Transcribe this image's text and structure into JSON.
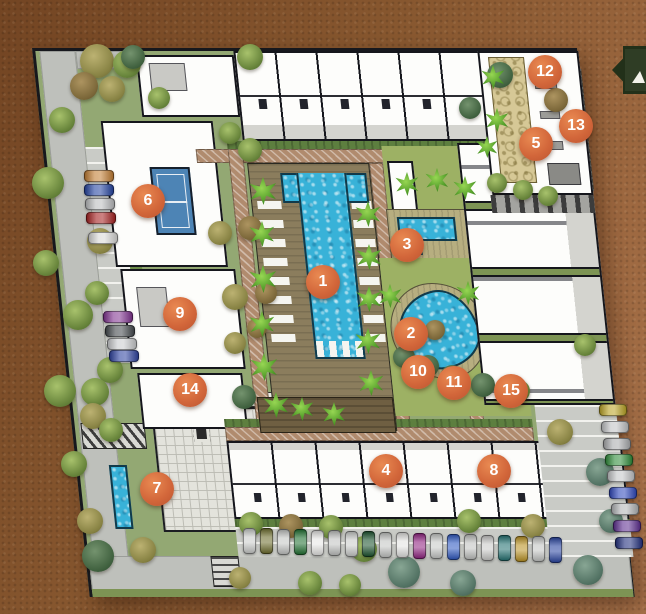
{
  "palette": {
    "marker_orange": "#d2663a",
    "pool_blue": "#38b2d8",
    "plan_green": "#93a873",
    "ribbon_green": "#2f3d25",
    "background_brown": "#8a5a33"
  },
  "markers": [
    {
      "n": "1",
      "x": 323,
      "y": 282
    },
    {
      "n": "2",
      "x": 411,
      "y": 334
    },
    {
      "n": "3",
      "x": 407,
      "y": 245
    },
    {
      "n": "4",
      "x": 386,
      "y": 471
    },
    {
      "n": "5",
      "x": 536,
      "y": 144
    },
    {
      "n": "6",
      "x": 148,
      "y": 201
    },
    {
      "n": "7",
      "x": 157,
      "y": 489
    },
    {
      "n": "8",
      "x": 494,
      "y": 471
    },
    {
      "n": "9",
      "x": 180,
      "y": 314
    },
    {
      "n": "10",
      "x": 418,
      "y": 372
    },
    {
      "n": "11",
      "x": 454,
      "y": 383
    },
    {
      "n": "12",
      "x": 545,
      "y": 72
    },
    {
      "n": "13",
      "x": 576,
      "y": 126
    },
    {
      "n": "14",
      "x": 190,
      "y": 390
    },
    {
      "n": "15",
      "x": 511,
      "y": 391
    }
  ],
  "ribbon": {
    "glyph": "sail-triangle-icon"
  },
  "trees": [
    [
      97,
      61,
      17,
      "o"
    ],
    [
      127,
      64,
      14,
      "g"
    ],
    [
      84,
      86,
      14,
      "b"
    ],
    [
      112,
      89,
      13,
      "o"
    ],
    [
      133,
      57,
      12,
      "k"
    ],
    [
      250,
      57,
      13,
      "g"
    ],
    [
      48,
      183,
      16,
      "g"
    ],
    [
      100,
      241,
      13,
      "o"
    ],
    [
      46,
      263,
      13,
      "g"
    ],
    [
      78,
      315,
      15,
      "g"
    ],
    [
      97,
      293,
      12,
      "g"
    ],
    [
      110,
      370,
      13,
      "g"
    ],
    [
      95,
      392,
      14,
      "g"
    ],
    [
      60,
      391,
      16,
      "g"
    ],
    [
      93,
      416,
      13,
      "o"
    ],
    [
      111,
      430,
      12,
      "g"
    ],
    [
      74,
      464,
      13,
      "g"
    ],
    [
      90,
      521,
      13,
      "o"
    ],
    [
      98,
      556,
      16,
      "k"
    ],
    [
      143,
      550,
      13,
      "o"
    ],
    [
      250,
      150,
      12,
      "g"
    ],
    [
      230,
      133,
      11,
      "g"
    ],
    [
      159,
      98,
      11,
      "g"
    ],
    [
      62,
      120,
      13,
      "g"
    ],
    [
      500,
      75,
      13,
      "k"
    ],
    [
      556,
      100,
      12,
      "b"
    ],
    [
      470,
      108,
      11,
      "k"
    ],
    [
      497,
      183,
      10,
      "g"
    ],
    [
      523,
      190,
      10,
      "g"
    ],
    [
      548,
      196,
      10,
      "g"
    ],
    [
      220,
      233,
      12,
      "o"
    ],
    [
      250,
      228,
      12,
      "b"
    ],
    [
      235,
      297,
      13,
      "o"
    ],
    [
      266,
      293,
      11,
      "b"
    ],
    [
      235,
      343,
      11,
      "o"
    ],
    [
      257,
      328,
      10,
      "b"
    ],
    [
      244,
      397,
      12,
      "k"
    ],
    [
      404,
      357,
      11,
      "k"
    ],
    [
      428,
      366,
      11,
      "k"
    ],
    [
      452,
      377,
      12,
      "k"
    ],
    [
      483,
      385,
      12,
      "k"
    ],
    [
      519,
      391,
      11,
      "g"
    ],
    [
      435,
      330,
      10,
      "b"
    ],
    [
      251,
      524,
      12,
      "g"
    ],
    [
      291,
      526,
      12,
      "b"
    ],
    [
      331,
      527,
      12,
      "g"
    ],
    [
      364,
      549,
      13,
      "g"
    ],
    [
      404,
      572,
      16,
      "t"
    ],
    [
      469,
      521,
      12,
      "g"
    ],
    [
      533,
      526,
      12,
      "o"
    ],
    [
      588,
      570,
      15,
      "t"
    ],
    [
      310,
      583,
      12,
      "g"
    ],
    [
      240,
      578,
      11,
      "o"
    ],
    [
      463,
      583,
      13,
      "t"
    ],
    [
      350,
      585,
      11,
      "g"
    ],
    [
      585,
      345,
      11,
      "g"
    ],
    [
      560,
      432,
      13,
      "o"
    ],
    [
      600,
      472,
      14,
      "t"
    ],
    [
      611,
      521,
      12,
      "t"
    ]
  ],
  "palms": [
    [
      263,
      191,
      14
    ],
    [
      262,
      234,
      13
    ],
    [
      263,
      279,
      14
    ],
    [
      262,
      324,
      13
    ],
    [
      264,
      367,
      14
    ],
    [
      276,
      405,
      13
    ],
    [
      368,
      214,
      13
    ],
    [
      369,
      257,
      13
    ],
    [
      369,
      299,
      13
    ],
    [
      368,
      341,
      13
    ],
    [
      371,
      383,
      13
    ],
    [
      407,
      184,
      12
    ],
    [
      437,
      180,
      12
    ],
    [
      465,
      188,
      12
    ],
    [
      302,
      409,
      12
    ],
    [
      334,
      414,
      12
    ],
    [
      493,
      77,
      12
    ],
    [
      497,
      120,
      12
    ],
    [
      487,
      147,
      11
    ],
    [
      390,
      296,
      12
    ],
    [
      468,
      293,
      12
    ]
  ],
  "cars": {
    "left_lot": {
      "orient": "h",
      "w": 30,
      "h": 12,
      "items": [
        [
          84,
          170,
          "#c07a2e"
        ],
        [
          84,
          184,
          "#1f3f9e"
        ],
        [
          85,
          198,
          "#b9bbbd"
        ],
        [
          86,
          212,
          "#a31c1c"
        ],
        [
          88,
          232,
          "#d8d8d6"
        ],
        [
          103,
          311,
          "#7e2f8e"
        ],
        [
          105,
          325,
          "#3f4448"
        ],
        [
          107,
          338,
          "#c8cacc"
        ],
        [
          109,
          350,
          "#2a3f9e"
        ]
      ]
    },
    "bottom_lot": {
      "orient": "v",
      "w": 13,
      "h": 26,
      "items": [
        [
          243,
          528,
          "#c9cbc9"
        ],
        [
          260,
          528,
          "#6b6b2a"
        ],
        [
          277,
          529,
          "#c2c4c2"
        ],
        [
          294,
          529,
          "#1d6e2e"
        ],
        [
          311,
          530,
          "#e6e6e4"
        ],
        [
          328,
          530,
          "#bfc1bf"
        ],
        [
          345,
          531,
          "#c9cbc9"
        ],
        [
          362,
          531,
          "#174f2a"
        ],
        [
          379,
          532,
          "#c2c4c2"
        ],
        [
          396,
          532,
          "#e2e2e0"
        ],
        [
          413,
          533,
          "#8e1f7e"
        ],
        [
          430,
          533,
          "#c6c8c6"
        ],
        [
          447,
          534,
          "#2a55c0"
        ],
        [
          464,
          534,
          "#bfc1bf"
        ],
        [
          481,
          535,
          "#c9c9c7"
        ],
        [
          498,
          535,
          "#1f6e6e"
        ],
        [
          515,
          536,
          "#b8901f"
        ],
        [
          532,
          536,
          "#c2c4c2"
        ],
        [
          549,
          537,
          "#24409e"
        ]
      ]
    },
    "right_lot": {
      "orient": "h",
      "w": 28,
      "h": 12,
      "items": [
        [
          599,
          404,
          "#b8a11f"
        ],
        [
          601,
          421,
          "#bfc1c3"
        ],
        [
          603,
          438,
          "#a8aaac"
        ],
        [
          605,
          454,
          "#2a8a35"
        ],
        [
          607,
          470,
          "#c2c4c6"
        ],
        [
          609,
          487,
          "#2a44bb"
        ],
        [
          611,
          503,
          "#b0b2b4"
        ],
        [
          613,
          520,
          "#5a2a8e"
        ],
        [
          615,
          537,
          "#1c2a7a"
        ]
      ]
    }
  }
}
